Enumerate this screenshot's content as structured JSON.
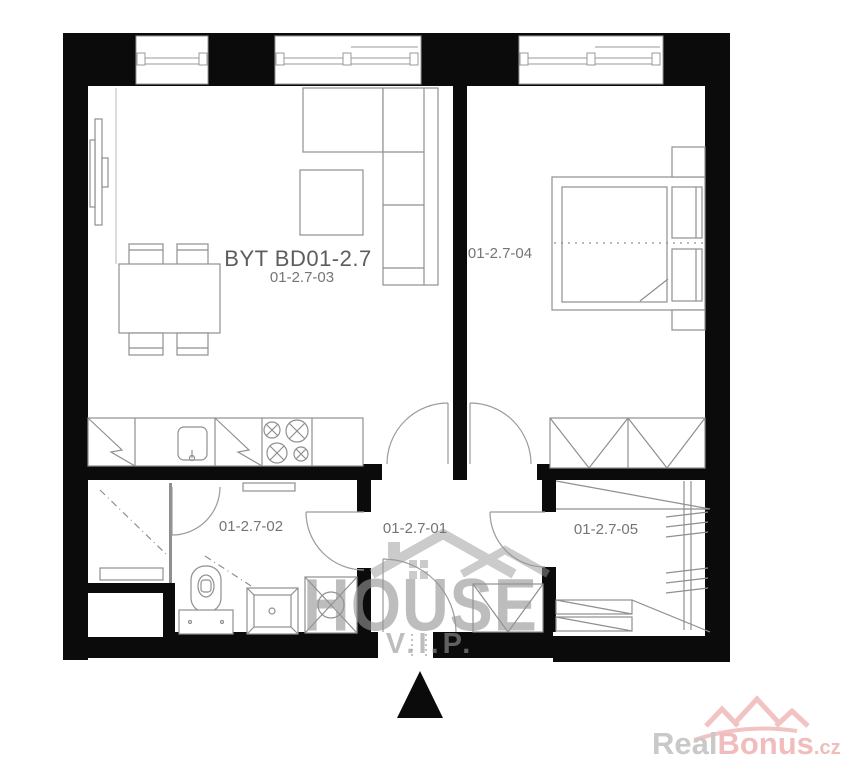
{
  "floorplan": {
    "unit_label": "BYT BD01-2.7",
    "rooms": {
      "living_kitchen": "01-2.7-03",
      "bedroom": "01-2.7-04",
      "bathroom": "01-2.7-02",
      "hallway": "01-2.7-01",
      "closet": "01-2.7-05"
    }
  },
  "watermark": {
    "title": "HOUSE",
    "subtitle": "V.I.P."
  },
  "brand": {
    "word1": "Real",
    "word2": "Bonus",
    "tld": ".cz"
  },
  "colors": {
    "wall": "#0b0b0b",
    "plan_line": "#8f8f8f",
    "label_text": "#757575",
    "watermark_gray": "#b0b0b0",
    "brand_gray": "#c9c9c9",
    "brand_pink": "#f0bcbc"
  }
}
